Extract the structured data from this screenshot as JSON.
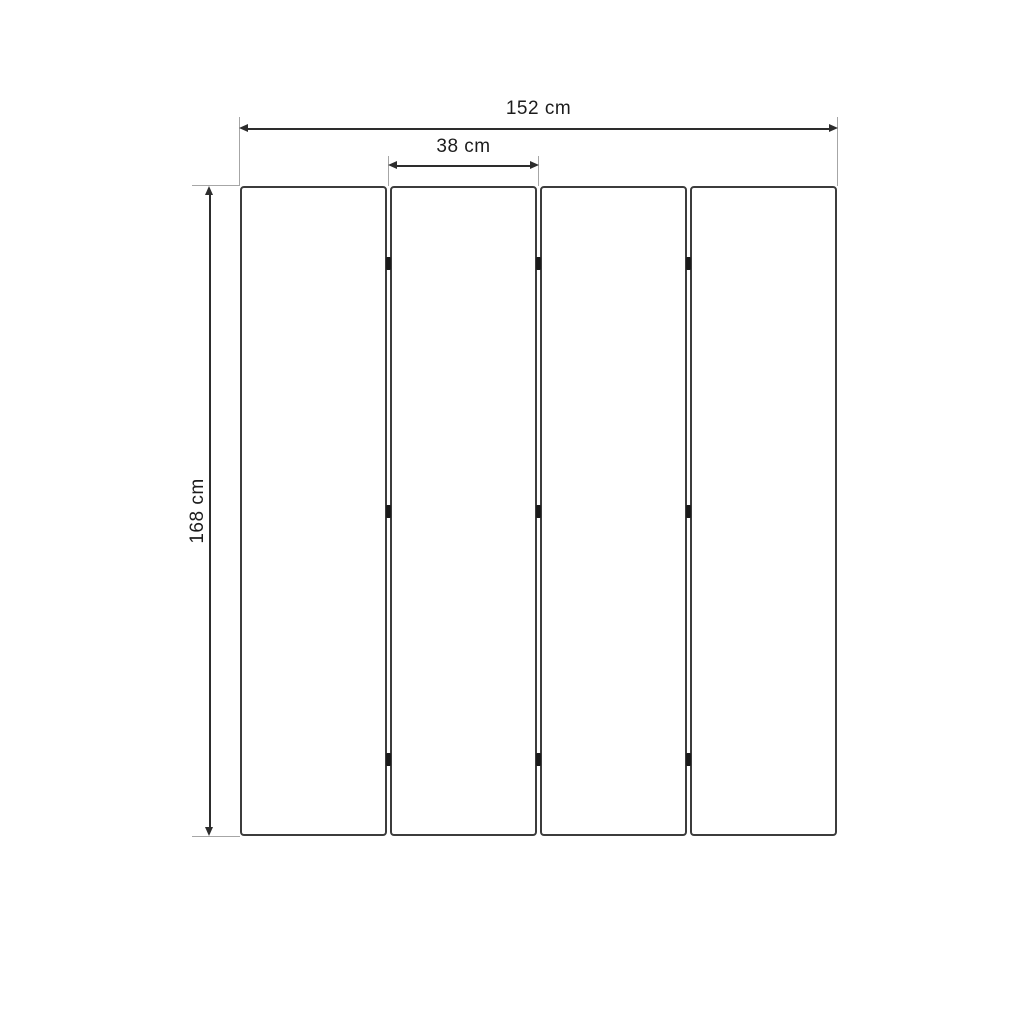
{
  "diagram": {
    "type": "furniture-dimension-drawing",
    "subject": "four-panel-folding-screen",
    "unit": "cm",
    "panel_count": 4,
    "hinge_rows": 3,
    "hinge_columns": 3,
    "dimensions": {
      "total_width": {
        "value": 152,
        "label": "152 cm"
      },
      "panel_width": {
        "value": 38,
        "label": "38 cm"
      },
      "height": {
        "value": 168,
        "label": "168 cm"
      }
    },
    "colors": {
      "background": "#ffffff",
      "panel_border": "#3c3c3c",
      "panel_fill": "#ffffff",
      "dimension_line": "#2d2d2d",
      "extension_line": "#a6a6a6",
      "hinge": "#1a1a1a",
      "text": "#1c1c1c"
    }
  }
}
